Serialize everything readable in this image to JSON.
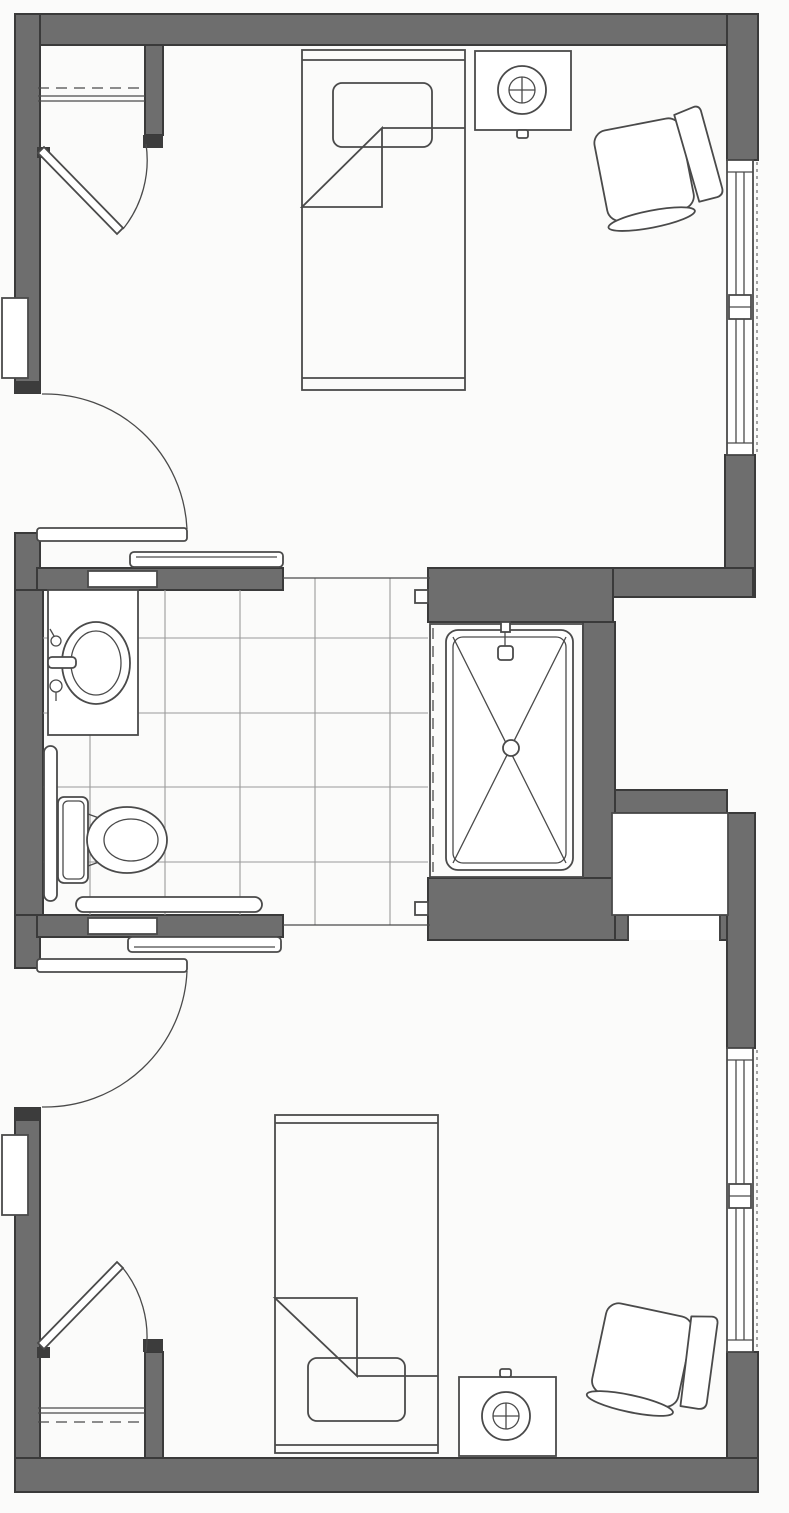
{
  "document": {
    "type": "scanned architectural floor plan (line drawing, no text labels)",
    "title": "Two bedrooms joined by a shared accessible bathroom - floor plan",
    "visible_text": []
  },
  "colors": {
    "paper": "#fbfbfa",
    "wall_fill": "#6e6e6e",
    "wall_edge": "#3a3a3a",
    "line": "#4a4a4a",
    "tile_line": "#9a9a9a"
  },
  "rooms": [
    {
      "name": "bedroom-top",
      "fixtures": [
        "hinged entry door (left wall, swing arc)",
        "closet with dashed shelf and double rod lines",
        "angled closet door with swing arc",
        "twin bed with headboard, pillow and folded-back blanket corner",
        "nightstand with round lamp",
        "rotated lounge chair",
        "right-wall window with center mullion",
        "small wall-mounted unit on left exterior wall"
      ]
    },
    {
      "name": "bathroom-center",
      "fixtures": [
        "sliding pocket door to top bedroom",
        "sliding pocket door to bottom bedroom",
        "vanity counter with oval sink and faucet handles",
        "toilet with tank",
        "vertical grab bar on left wall",
        "horizontal grab bar on south wall",
        "roll-in shower with rounded pan, X slope lines to center drain, shower head and dashed curtain line",
        "square floor tile grid"
      ]
    },
    {
      "name": "bedroom-bottom",
      "fixtures": [
        "hinged entry door (left wall, swing arc)",
        "closet with dashed shelf and double rod lines",
        "angled closet door with swing arc",
        "twin bed with pillow and folded-back blanket corner",
        "nightstand with round lamp",
        "rotated lounge chair",
        "right-wall window with center mullion",
        "small wall-mounted unit on left exterior wall"
      ]
    },
    {
      "name": "right-side-recesses",
      "fixtures": [
        "open alcove recessed from right edge",
        "enclosed storage niche with slot opening to bottom bedroom"
      ]
    }
  ]
}
